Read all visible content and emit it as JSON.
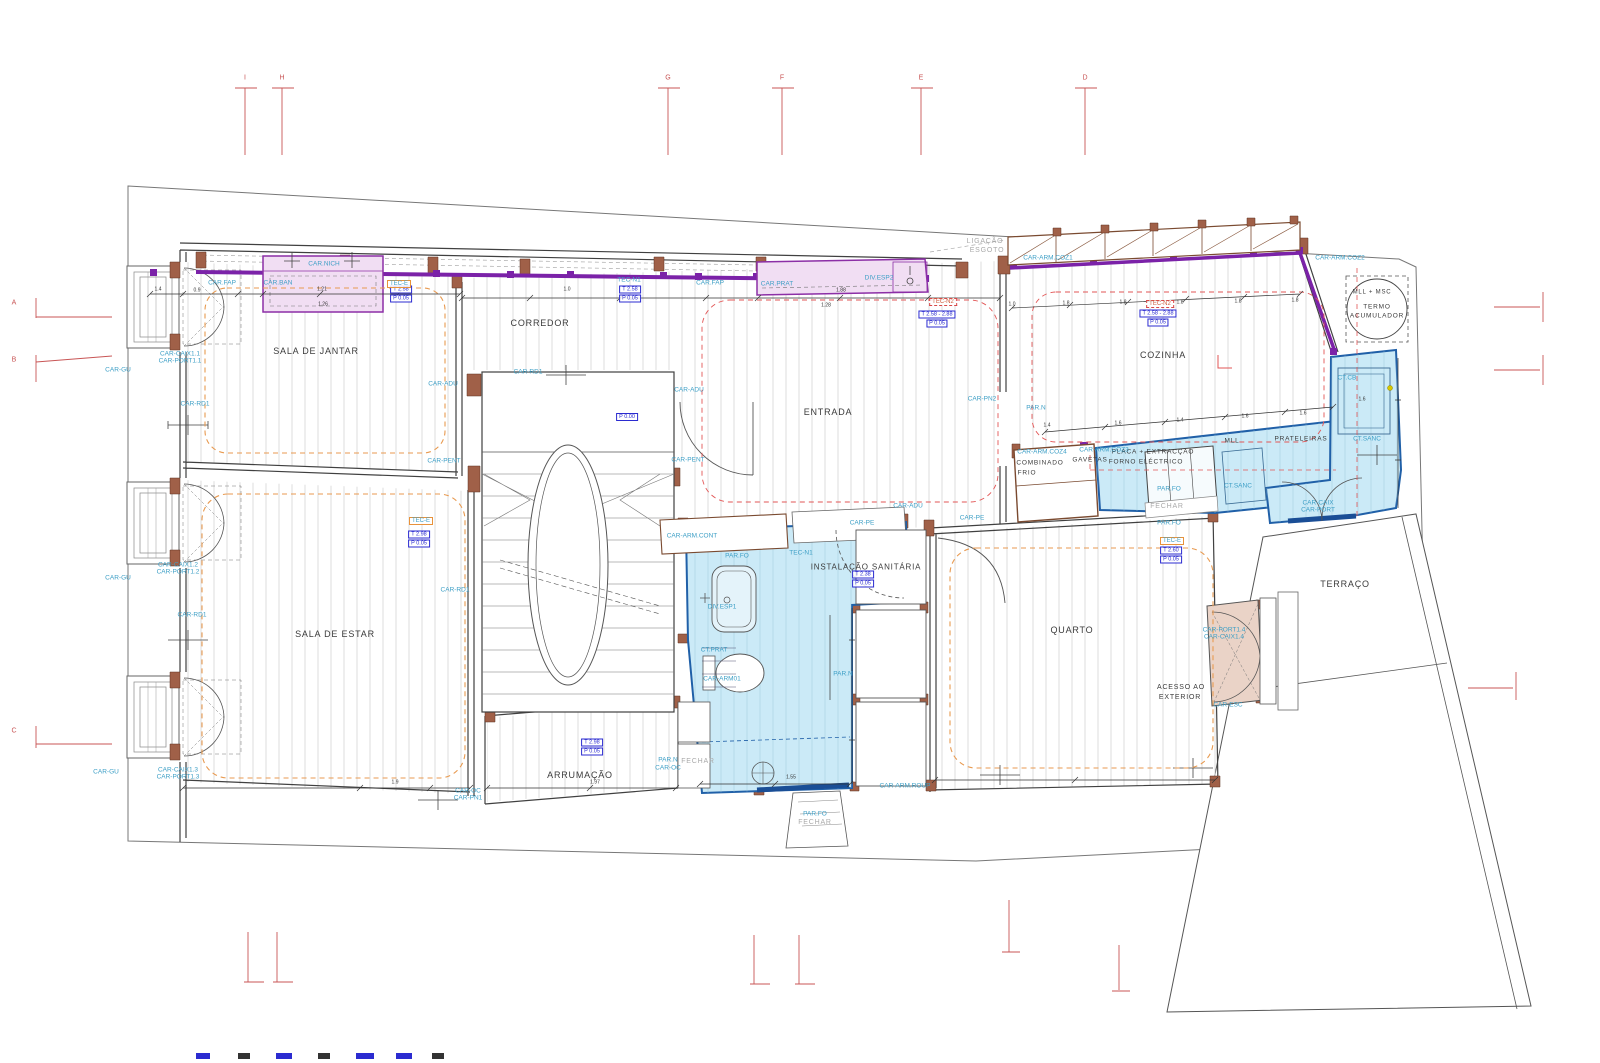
{
  "drawing": {
    "type": "architectural-floor-plan"
  },
  "grid": {
    "top": [
      {
        "label": "I",
        "x": 245
      },
      {
        "label": "H",
        "x": 282
      },
      {
        "label": "G",
        "x": 668
      },
      {
        "label": "F",
        "x": 782
      },
      {
        "label": "E",
        "x": 921
      },
      {
        "label": "D",
        "x": 1085
      }
    ],
    "left": [
      {
        "label": "A",
        "y": 303
      },
      {
        "label": "B",
        "y": 360
      },
      {
        "label": "C",
        "y": 731
      }
    ]
  },
  "labels": {
    "dark": [
      [
        316,
        352,
        "SALA DE JANTAR",
        9
      ],
      [
        540,
        324,
        "CORREDOR",
        9
      ],
      [
        828,
        413,
        "ENTRADA",
        9
      ],
      [
        1163,
        356,
        "COZINHA",
        9
      ],
      [
        335,
        635,
        "SALA DE ESTAR",
        9
      ],
      [
        1072,
        631,
        "QUARTO",
        9
      ],
      [
        580,
        776,
        "ARRUMAÇÃO",
        9
      ],
      [
        866,
        568,
        "INSTALAÇÃO SANITÁRIA",
        8
      ],
      [
        1345,
        585,
        "TERRAÇO",
        9
      ],
      [
        1377,
        307,
        "TERMO",
        6.5
      ],
      [
        1377,
        316,
        "ACUMULADOR",
        6.5
      ],
      [
        1372,
        293,
        "MLL + MSC",
        6
      ],
      [
        1153,
        452,
        "PLACA + EXTRACÇÃO",
        6.5
      ],
      [
        1146,
        462,
        "FORNO ELÉCTRICO",
        6.5
      ],
      [
        1040,
        463,
        "COMBINADO",
        6.5
      ],
      [
        1027,
        473,
        "FRIO",
        6.5
      ],
      [
        1090,
        460,
        "GAVETAS",
        6.5
      ],
      [
        1232,
        441,
        "MLL",
        6.5
      ],
      [
        1301,
        439,
        "PRATELEIRAS",
        6.5
      ],
      [
        1181,
        688,
        "ACESSO AO",
        7
      ],
      [
        1180,
        698,
        "EXTERIOR",
        7
      ]
    ],
    "cyan": [
      [
        222,
        283,
        "CAR.FAP"
      ],
      [
        278,
        283,
        "CAR.BAN"
      ],
      [
        324,
        264,
        "CAR.NICH"
      ],
      [
        710,
        283,
        "CAR.FAP"
      ],
      [
        777,
        284,
        "CAR.PRAT"
      ],
      [
        879,
        278,
        "DIV.ESP2"
      ],
      [
        1048,
        258,
        "CAR-ARM.COZ1"
      ],
      [
        1340,
        258,
        "CAR-ARM.COZ2"
      ],
      [
        118,
        370,
        "CAR-GU"
      ],
      [
        118,
        578,
        "CAR-GU"
      ],
      [
        106,
        772,
        "CAR-GU"
      ],
      [
        180,
        354,
        "CAR-CAIX1.1"
      ],
      [
        180,
        361,
        "CAR-PORT1.1"
      ],
      [
        178,
        565,
        "CAR-CAIX1.2"
      ],
      [
        178,
        572,
        "CAR-PORT1.2"
      ],
      [
        178,
        770,
        "CAR-CAIX1.3"
      ],
      [
        178,
        777,
        "CAR-PORT1.3"
      ],
      [
        195,
        404,
        "CAR-RD1"
      ],
      [
        192,
        615,
        "CAR-RD1"
      ],
      [
        455,
        590,
        "CAR-RD1"
      ],
      [
        528,
        372,
        "CAR-RD1"
      ],
      [
        443,
        384,
        "CAR-ADU"
      ],
      [
        689,
        390,
        "CAR-ADU"
      ],
      [
        908,
        506,
        "CAR-ADU"
      ],
      [
        444,
        461,
        "CAR-PENT"
      ],
      [
        688,
        460,
        "CAR-PENT"
      ],
      [
        862,
        523,
        "CAR-PE"
      ],
      [
        972,
        518,
        "CAR-PE"
      ],
      [
        982,
        399,
        "CAR-PN2"
      ],
      [
        1036,
        408,
        "PAR.N"
      ],
      [
        692,
        536,
        "CAR-ARM.CONT"
      ],
      [
        737,
        556,
        "PAR.FO"
      ],
      [
        801,
        553,
        "TEC-N1"
      ],
      [
        629,
        280,
        "TEC-N1"
      ],
      [
        722,
        607,
        "DIV.ESP1"
      ],
      [
        714,
        650,
        "CT.PRAT"
      ],
      [
        722,
        679,
        "CAR-ARM01"
      ],
      [
        843,
        674,
        "PAR.N"
      ],
      [
        668,
        760,
        "PAR.N"
      ],
      [
        668,
        768,
        "CAR-OC"
      ],
      [
        468,
        791,
        "CAR-OC"
      ],
      [
        468,
        798,
        "CAR-PN1"
      ],
      [
        905,
        786,
        "CAR-ARM.ROUP"
      ],
      [
        815,
        814,
        "PAR.FO"
      ],
      [
        1169,
        489,
        "PAR.FO"
      ],
      [
        1169,
        523,
        "PAR.FO"
      ],
      [
        1042,
        452,
        "CAR-ARM.COZ4"
      ],
      [
        1104,
        450,
        "CAR-ARM.COZ3"
      ],
      [
        1238,
        486,
        "CT.SANC"
      ],
      [
        1367,
        439,
        "CT.SANC"
      ],
      [
        1347,
        378,
        "CT.CB"
      ],
      [
        1318,
        503,
        "CAR-CAIX"
      ],
      [
        1318,
        510,
        "CAR-PORT"
      ],
      [
        1224,
        630,
        "CAR-PORT1.4"
      ],
      [
        1224,
        637,
        "CAR-CAIX1.4"
      ],
      [
        1228,
        705,
        "CAR-ESC"
      ]
    ],
    "gray": [
      [
        985,
        242,
        "LIGAÇÃO"
      ],
      [
        987,
        251,
        "ESGOTO"
      ],
      [
        698,
        762,
        "FECHAR"
      ],
      [
        1167,
        507,
        "FECHAR"
      ],
      [
        815,
        823,
        "FECHAR"
      ]
    ],
    "dims": [
      [
        158,
        290,
        "1.4"
      ],
      [
        197,
        291,
        "0.9"
      ],
      [
        322,
        290,
        "1.21"
      ],
      [
        323,
        305,
        "1.26"
      ],
      [
        567,
        290,
        "1.0"
      ],
      [
        841,
        291,
        "1.88"
      ],
      [
        826,
        306,
        "1.28"
      ],
      [
        1012,
        305,
        "1.0"
      ],
      [
        1066,
        304,
        "1.8"
      ],
      [
        1123,
        303,
        "1.8"
      ],
      [
        1180,
        303,
        "1.8"
      ],
      [
        1238,
        302,
        "1.8"
      ],
      [
        1295,
        301,
        "1.8"
      ],
      [
        1047,
        426,
        "1.4"
      ],
      [
        1118,
        424,
        "1.6"
      ],
      [
        1180,
        421,
        "1.4"
      ],
      [
        1245,
        417,
        "1.6"
      ],
      [
        1303,
        414,
        "1.6"
      ],
      [
        395,
        783,
        "1.9"
      ],
      [
        595,
        783,
        "1.97"
      ],
      [
        791,
        778,
        "1.55"
      ],
      [
        1362,
        400,
        "1.6"
      ]
    ]
  },
  "boxes": {
    "blue": [
      {
        "x": 401,
        "y": 294,
        "lines": [
          "T 2.58",
          "P 0.05"
        ]
      },
      {
        "x": 630,
        "y": 294,
        "lines": [
          "T 2.58",
          "P 0.05"
        ]
      },
      {
        "x": 937,
        "y": 319,
        "lines": [
          "T 2.58 - 2.88",
          "P 0.05"
        ]
      },
      {
        "x": 1158,
        "y": 318,
        "lines": [
          "T 2.58 - 2.88",
          "P 0.05"
        ]
      },
      {
        "x": 863,
        "y": 579,
        "lines": [
          "T 2.38",
          "P 0.05"
        ]
      },
      {
        "x": 419,
        "y": 539,
        "lines": [
          "T 2.98",
          "P 0.05"
        ]
      },
      {
        "x": 592,
        "y": 747,
        "lines": [
          "T 2.98",
          "P 0.05"
        ]
      },
      {
        "x": 1171,
        "y": 555,
        "lines": [
          "T 2.60",
          "P 0.05"
        ]
      },
      {
        "x": 627,
        "y": 417,
        "lines": [
          "P 0.00"
        ]
      }
    ],
    "tec": [
      {
        "x": 399,
        "y": 284,
        "text": "TEC-E",
        "style": "orange"
      },
      {
        "x": 421,
        "y": 521,
        "text": "TEC-E",
        "style": "orange"
      },
      {
        "x": 1172,
        "y": 541,
        "text": "TEC-E",
        "style": "orange"
      },
      {
        "x": 943,
        "y": 302,
        "text": "TEC-N2",
        "style": "red"
      },
      {
        "x": 1160,
        "y": 304,
        "text": "TEC-N2",
        "style": "red"
      }
    ]
  },
  "colors": {
    "cyan_label": "#3D9FC6",
    "blue_box": "#2B2BD0",
    "purple_band": "#7B22A8",
    "mauve_fill": "#F1DEF3",
    "blue_fill": "#CBEAF7",
    "blue_stroke": "#2060A8",
    "wall_brown": "#A06048",
    "orange_dash": "#E89A50",
    "red_dash": "#E25555",
    "grid_red": "#C85555"
  }
}
